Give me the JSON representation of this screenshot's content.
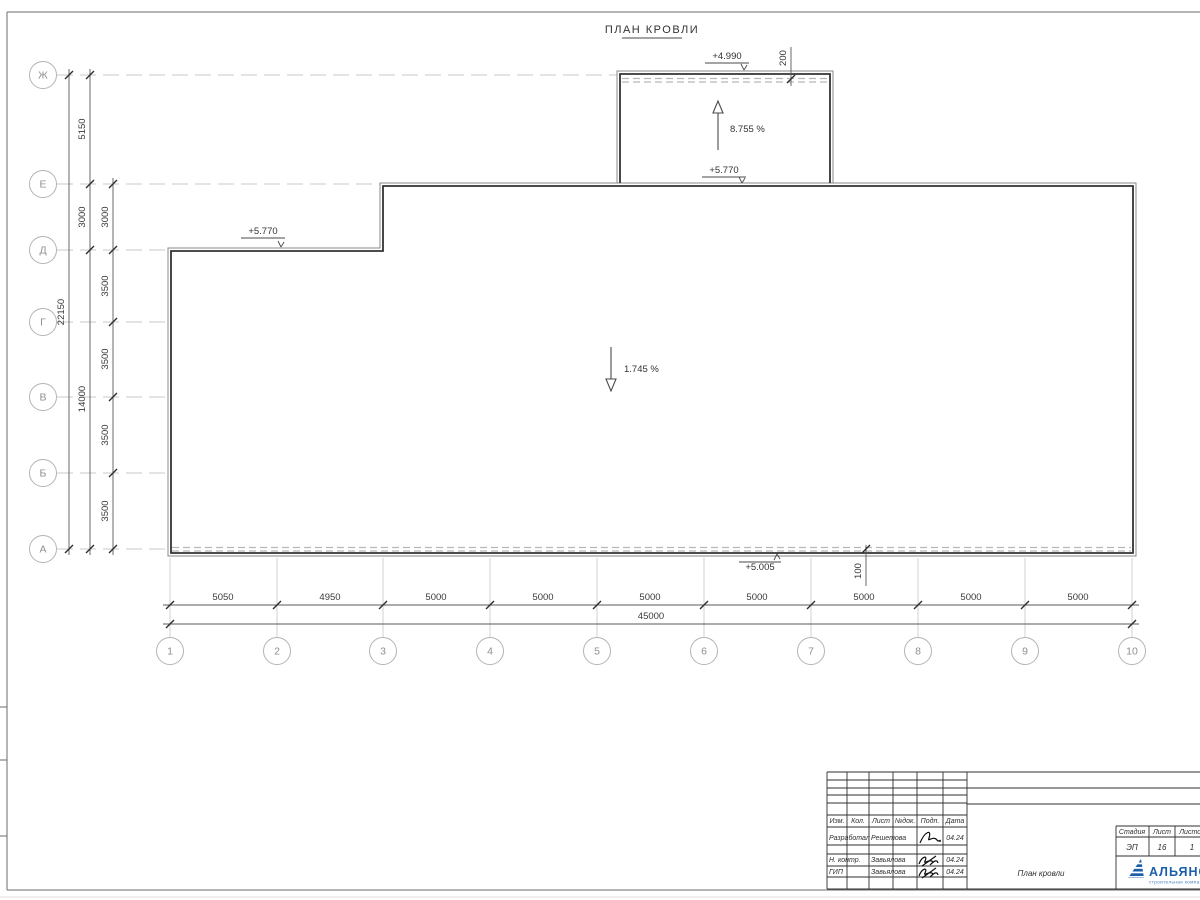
{
  "sheet": {
    "title": "ПЛАН КРОВЛИ"
  },
  "axes": {
    "left": [
      "Ж",
      "Е",
      "Д",
      "Г",
      "В",
      "Б",
      "А"
    ],
    "bottom": [
      "1",
      "2",
      "3",
      "4",
      "5",
      "6",
      "7",
      "8",
      "9",
      "10"
    ]
  },
  "dims": {
    "bottom_bays": [
      "5050",
      "4950",
      "5000",
      "5000",
      "5000",
      "5000",
      "5000",
      "5000",
      "5000"
    ],
    "bottom_total": "45000",
    "left_total": "22150",
    "left_mid": [
      "5150",
      "3000",
      "14000"
    ],
    "left_inner": [
      "3000",
      "3500",
      "3500",
      "3500",
      "3500"
    ],
    "parapet_offset_top": "200",
    "parapet_offset_bottom": "100"
  },
  "ann": {
    "elev_upper": "+4.990",
    "elev_upper_base": "+5.770",
    "elev_left": "+5.770",
    "elev_gutter": "+5.005",
    "slope_upper": "8.755 %",
    "slope_main": "1.745 %"
  },
  "tb": {
    "header_cols": [
      "Изм.",
      "Кол.",
      "Лист",
      "№док.",
      "Подп.",
      "Дата"
    ],
    "rows": [
      {
        "role": "Разработал",
        "name": "Решетова",
        "date": "04.24"
      },
      {
        "role": "Н. контр.",
        "name": "Завьялова",
        "date": "04.24"
      },
      {
        "role": "ГИП",
        "name": "Завьялова",
        "date": "04.24"
      }
    ],
    "doc_title": "План кровли",
    "stage_label": "Стадия",
    "sheet_label": "Лист",
    "sheets_label": "Листов",
    "stage_value": "ЭП",
    "sheet_value": "16",
    "sheets_value": "1",
    "logo_text": "АЛЬЯНС",
    "logo_subtext": "строительная компания",
    "logo_color": "#1b5ea9"
  }
}
